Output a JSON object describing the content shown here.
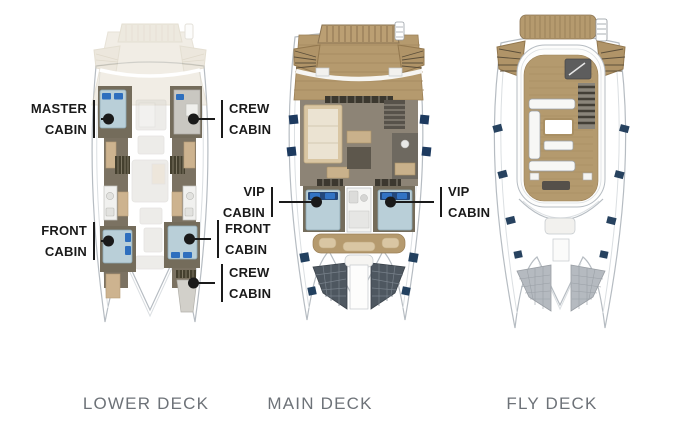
{
  "decks": [
    {
      "id": "lower",
      "title": "LOWER DECK"
    },
    {
      "id": "main",
      "title": "MAIN DECK"
    },
    {
      "id": "fly",
      "title": "FLY DECK"
    }
  ],
  "callouts": [
    {
      "id": "master-cabin",
      "deck": "lower",
      "line1": "MASTER",
      "line2": "CABIN"
    },
    {
      "id": "crew-cabin-upper",
      "deck": "lower",
      "line1": "CREW",
      "line2": "CABIN"
    },
    {
      "id": "front-cabin-port",
      "deck": "lower",
      "line1": "FRONT",
      "line2": "CABIN"
    },
    {
      "id": "front-cabin-starboard",
      "deck": "lower",
      "line1": "FRONT",
      "line2": "CABIN"
    },
    {
      "id": "crew-cabin-lower",
      "deck": "lower",
      "line1": "CREW",
      "line2": "CABIN"
    },
    {
      "id": "vip-cabin-port",
      "deck": "main",
      "line1": "VIP",
      "line2": "CABIN"
    },
    {
      "id": "vip-cabin-starboard",
      "deck": "main",
      "line1": "VIP",
      "line2": "CABIN"
    }
  ],
  "colors": {
    "background": "#ffffff",
    "label_text": "#1a1a1a",
    "title_text": "#6d7278",
    "wood_deck": "#b59a6e",
    "ghost_deck": "#e6dfd0",
    "hull_outline": "#b6bcc2",
    "cabin_wall": "#746c5b",
    "salon_floor": "#8d8476",
    "bed_blue": "#b9cfd8",
    "pillow_blue": "#2e6fbe",
    "pillow_navy": "#24487c",
    "window_navy": "#1d3a5f",
    "trampoline_dark": "#4e5760",
    "trampoline_gray": "#b5bac0"
  }
}
